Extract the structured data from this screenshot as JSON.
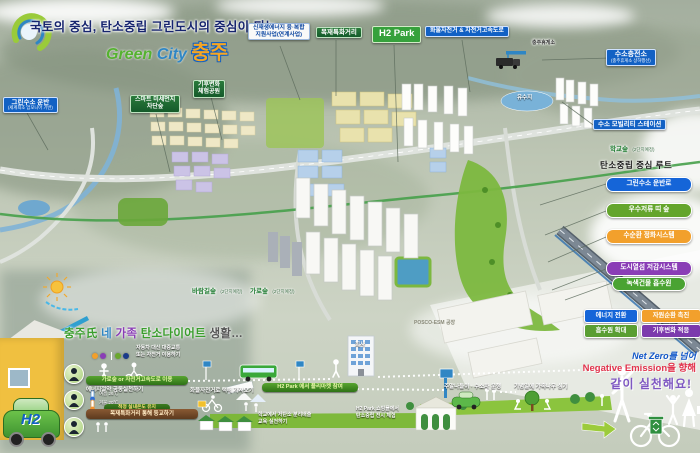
{
  "header": {
    "tagline": "국토의 중심, 탄소중립 그린도시의 중심이 되는",
    "logo_green": "Green",
    "logo_city": "City",
    "logo_city_name": "충주"
  },
  "top_labels": {
    "renewable_l1": "신재생에너지 융·복합",
    "renewable_l2": "지원사업(연계사업)",
    "wood_street": "목재특화거리",
    "h2_park": "H2 Park",
    "cargo_bike_highway": "화물자전거 & 자전거고속도로"
  },
  "left_labels": {
    "green_h2_transport": "그린수소 운반",
    "green_h2_transport_sub": "(세계최초 암모니아 기반)",
    "smart_forest_l1": "스마트 미세먼지",
    "smart_forest_l2": "차단숲",
    "climate_park_l1": "기후변화",
    "climate_park_l2": "체험공원"
  },
  "map_labels": {
    "rest_area": "충주휴게소",
    "h2_station": "수소충전소",
    "h2_station_sub": "(충주휴게소 상하행선)",
    "reservoir": "유수지",
    "mobility_station": "수소 모빌리티 스테이션",
    "school_forest": "학교숲",
    "school_forest_sub": "(2단지예정)",
    "wind_forest": "바람길숲",
    "wind_forest_sub": "(2단지예정)",
    "street_forest": "가로숲",
    "street_forest_sub": "(2단지예정)",
    "posco": "POSCO-ESM 공장",
    "company": "회사"
  },
  "route_panel": {
    "title": "탄소중립 중심 루트",
    "items": [
      {
        "label": "그린수소 운반로",
        "color": "#1565d8"
      },
      {
        "label": "우수저류 띠 숲",
        "color": "#64a52c"
      },
      {
        "label": "수순환 정화시스템",
        "color": "#f2a02c"
      },
      {
        "label": "도시열섬 저감시스템",
        "color": "#8a3db6"
      }
    ],
    "absorber": "녹색건물 흡수원"
  },
  "strategy": {
    "items": [
      {
        "label": "에너지 전환",
        "color": "#1565d8"
      },
      {
        "label": "자원순환 촉진",
        "color": "#f2a02c"
      },
      {
        "label": "흡수원 확대",
        "color": "#5a9e33"
      },
      {
        "label": "기후변화 적응",
        "color": "#7c3aad"
      }
    ]
  },
  "slogan": {
    "line1": "Net Zero를 넘어",
    "line2": "Negative Emission을 향해",
    "line3": "같이 실천해요!"
  },
  "family": {
    "title_parts": [
      {
        "t": "충주氏",
        "c": "#3a9e2d"
      },
      {
        "t": "네",
        "c": "#2f86c4"
      },
      {
        "t": "가족",
        "c": "#8a3db6"
      },
      {
        "t": "탄소다이어트",
        "c": "#3a9e2d"
      },
      {
        "t": "생활…",
        "c": "#555555"
      }
    ],
    "legend_l1": "자동차 대신 대중교통",
    "legend_l2": "또는 자전거 이용하기",
    "car_badge": "H2",
    "row1": "가로숲 or 자전거고속도로 이용",
    "row2_label": "에너지절약 공동실천하기",
    "row2_temp_summer": "여름 26℃",
    "row2_temp_winter": "겨울 20℃",
    "row2_bar": "적정 실내온도 유지",
    "row2_delivery": "화물자전거로 택배 가져오기",
    "row2_market": "H2 Park 에서 플리마켓 참여",
    "row3_school_route": "목재특화거리 통해 등교하기",
    "row3_edu_l1": "학교에서 저탄소 분리배출",
    "row3_edu_l2": "교육·실천하기",
    "weekend": "주말나들이 · 수소차 운행",
    "anniversary": "기념일에 가족나무 심기",
    "shopping_l1": "H2 Park 쇼핑몰에서",
    "shopping_l2": "탄소중립 전시 체험"
  }
}
